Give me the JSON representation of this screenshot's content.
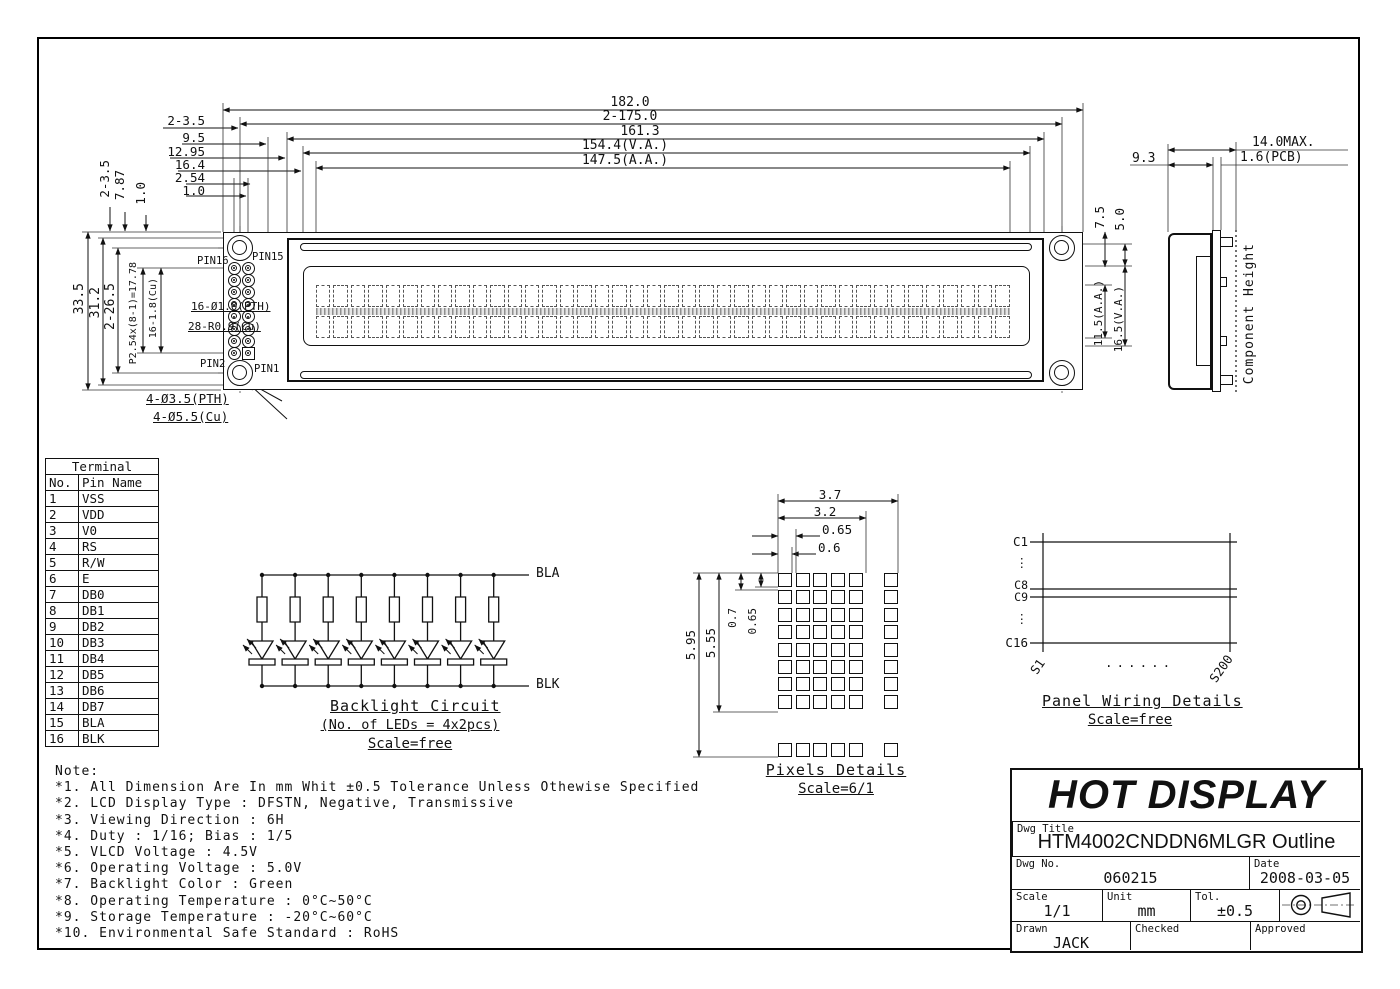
{
  "drawing": {
    "fv": {
      "top": [
        "182.0",
        "2-175.0",
        "161.3",
        "154.4(V.A.)",
        "147.5(A.A.)"
      ],
      "stack": [
        "2-3.5",
        "9.5",
        "12.95",
        "16.4",
        "2.54",
        "1.0"
      ],
      "vstack": [
        "2-3.5",
        "7.87",
        "1.0"
      ],
      "left": [
        "33.5",
        "31.2",
        "2-26.5",
        "P2.54x(8-1)=17.78",
        "16-1.8(Cu)"
      ],
      "right": [
        "7.5",
        "5.0",
        "11.5(A.A.)",
        "16.5(V.A.)"
      ],
      "pins": {
        "p16": "PIN16",
        "p15": "PIN15",
        "p2": "PIN2",
        "p1": "PIN1"
      },
      "pads": [
        "16-Ø1.0(PTH)",
        "28-R0.9(Cu)"
      ],
      "mounts": [
        "4-Ø3.5(PTH)",
        "4-Ø5.5(Cu)"
      ],
      "chars_per_row": 40,
      "char_rows": 2,
      "pin_count": 16
    },
    "sv": {
      "dims": [
        "9.3",
        "14.0MAX.",
        "1.6(PCB)"
      ],
      "component_height": "Component Height"
    },
    "terminal_table": {
      "title": "Terminal",
      "col_headers": [
        "No.",
        "Pin Name"
      ],
      "rows": [
        [
          "1",
          "VSS"
        ],
        [
          "2",
          "VDD"
        ],
        [
          "3",
          "V0"
        ],
        [
          "4",
          "RS"
        ],
        [
          "5",
          "R/W"
        ],
        [
          "6",
          "E"
        ],
        [
          "7",
          "DB0"
        ],
        [
          "8",
          "DB1"
        ],
        [
          "9",
          "DB2"
        ],
        [
          "10",
          "DB3"
        ],
        [
          "11",
          "DB4"
        ],
        [
          "12",
          "DB5"
        ],
        [
          "13",
          "DB6"
        ],
        [
          "14",
          "DB7"
        ],
        [
          "15",
          "BLA"
        ],
        [
          "16",
          "BLK"
        ]
      ]
    },
    "backlight": {
      "anode_label": "BLA",
      "cathode_label": "BLK",
      "title": "Backlight Circuit",
      "subtitle": "(No. of LEDs = 4x2pcs)",
      "scale": "Scale=free",
      "branches": 8
    },
    "pixels": {
      "top_dims": [
        "3.7",
        "3.2",
        "0.65",
        "0.6"
      ],
      "left_dims": [
        "5.95",
        "5.55",
        "0.7",
        "0.65"
      ],
      "title": "Pixels Details",
      "scale": "Scale=6/1"
    },
    "panel_wiring": {
      "row_labels": [
        "C1",
        "⋮",
        "C8",
        "C9",
        "⋮",
        "C16"
      ],
      "col_labels": [
        "S1",
        "S200"
      ],
      "dots": "......",
      "title": "Panel Wiring Details",
      "scale": "Scale=free"
    },
    "notes": {
      "title": "Note:",
      "items": [
        "*1. All Dimension Are In mm Whit ±0.5 Tolerance Unless Othewise Specified",
        "*2. LCD Display Type : DFSTN, Negative, Transmissive",
        "*3. Viewing Direction : 6H",
        "*4. Duty : 1/16; Bias : 1/5",
        "*5. VLCD Voltage : 4.5V",
        "*6. Operating Voltage : 5.0V",
        "*7. Backlight Color : Green",
        "*8. Operating Temperature : 0°C~50°C",
        "*9. Storage Temperature : -20°C~60°C",
        "*10. Environmental Safe Standard : RoHS"
      ]
    },
    "title_block": {
      "company": "HOT DISPLAY",
      "dwg_title_label": "Dwg Title",
      "dwg_title": "HTM4002CNDDN6MLGR Outline",
      "dwg_no_label": "Dwg No.",
      "dwg_no": "060215",
      "date_label": "Date",
      "date": "2008-03-05",
      "scale_label": "Scale",
      "scale": "1/1",
      "unit_label": "Unit",
      "unit": "mm",
      "tol_label": "Tol.",
      "tol": "±0.5",
      "drawn_label": "Drawn",
      "drawn": "JACK",
      "checked_label": "Checked",
      "checked": "",
      "approved_label": "Approved",
      "approved": ""
    }
  }
}
